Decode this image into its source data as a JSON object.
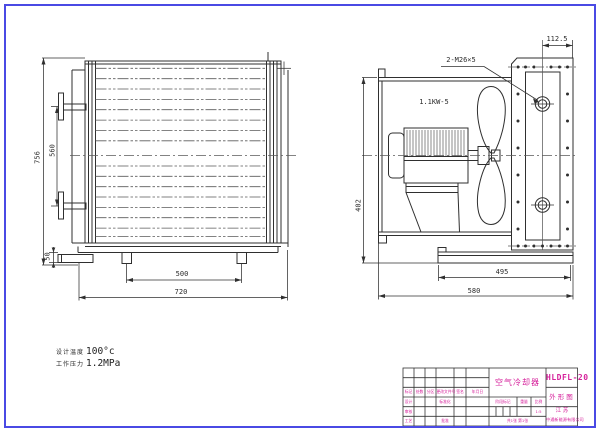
{
  "page": {
    "type": "engineering-drawing",
    "background": "#ffffff",
    "frame_color": "#4a4ae4",
    "line_color": "#2f2f2f",
    "accent_text_color": "#d6219b"
  },
  "front_view": {
    "dim_total_height": "756",
    "dim_bracket_span": "560",
    "dim_stub": "50",
    "dim_feet_span": "500",
    "dim_total_width": "720"
  },
  "side_view": {
    "motor_label": "1.1KW-5",
    "thread_label": "2-M26×5",
    "dim_flange_offset": "112.5",
    "dim_height": "402",
    "dim_base_inner": "495",
    "dim_base_total": "580"
  },
  "notes": {
    "design_temp_label": "设计温度",
    "design_temp_value": "100°c",
    "work_pressure_label": "工作压力",
    "work_pressure_value": "1.2MPa"
  },
  "title_block": {
    "product_name": "空气冷却器",
    "drawing_no": "HLDFL-20",
    "sheet_name": "外形图",
    "company_region": "江  苏",
    "company_name": "中通新能源有限公司",
    "rev_headers": [
      "标记",
      "处数",
      "分区",
      "更改文件号",
      "签名",
      "年月日"
    ],
    "row_design": "设计",
    "row_standard": "标准化",
    "row_check": "审核",
    "row_process": "工艺",
    "row_approve": "批准",
    "stage_label": "阶段标记",
    "weight_label": "重量",
    "scale_label": "比例",
    "scale_value": "1:5",
    "sheet_info": "共1张 第1张"
  }
}
